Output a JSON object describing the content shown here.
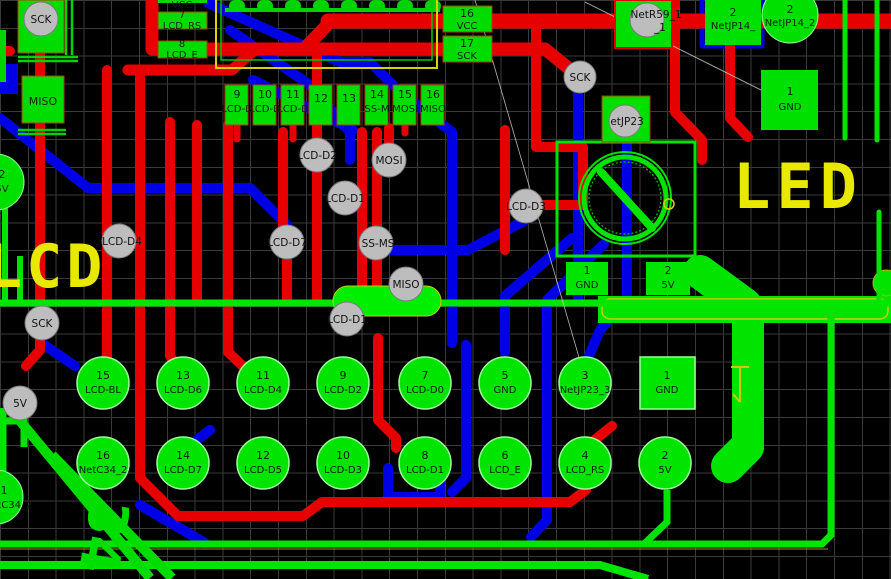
{
  "colors": {
    "copper_top": "#e60000",
    "copper_bottom": "#0000e6",
    "copper_green": "#00e400",
    "pad": "#00e400",
    "via": "#bdbdbd",
    "silk": "#e9e900",
    "grid": "#3a3a3a",
    "bg": "#000000"
  },
  "silkscreen": {
    "led_label": "LED",
    "lcd_label": "LCD",
    "label_34": "34"
  },
  "vias": {
    "sck_tl": "SCK",
    "sck_tr": "SCK",
    "sck_mid": "SCK",
    "v5": "5V",
    "d2": "LCD-D2",
    "mosi": "MOSI",
    "d1a": "LCD-D1",
    "d3": "LCD-D3",
    "d4": "LCD-D4",
    "d7": "LCD-D7",
    "ssms": "SS-MS",
    "miso": "MISO",
    "d1b": "LCD-D1",
    "netr59": "NetR59_1",
    "netr59b": "_1",
    "netjp23": "etJP23"
  },
  "top_header": {
    "pads": [
      {
        "num": "9",
        "net": "LCD-D"
      },
      {
        "num": "10",
        "net": "LCD-D"
      },
      {
        "num": "11",
        "net": "LCD-D"
      },
      {
        "num": "12",
        "net": ""
      },
      {
        "num": "13",
        "net": ""
      },
      {
        "num": "14",
        "net": "SS-M"
      },
      {
        "num": "15",
        "net": "MOSI"
      },
      {
        "num": "16",
        "net": "MISO"
      }
    ]
  },
  "left_header": {
    "l1": "VCC",
    "l2": "7",
    "l3": "LCD_RS",
    "l4": "8",
    "l5": "LCD_E"
  },
  "mid_pads": {
    "p16": {
      "num": "16",
      "net": "VCC"
    },
    "p17": {
      "num": "17",
      "net": "SCK"
    }
  },
  "tr": {
    "sq": {
      "num": "2",
      "net": "NetJP14_"
    },
    "circ": {
      "num": "2",
      "net": "NetJP14_2"
    },
    "gnd": {
      "num": "1",
      "net": "GND"
    }
  },
  "led": {
    "p1": {
      "num": "1",
      "net": "GND"
    },
    "p2": {
      "num": "2",
      "net": "5V"
    }
  },
  "bottom_header": {
    "row1": [
      {
        "num": "15",
        "net": "LCD-BL"
      },
      {
        "num": "13",
        "net": "LCD-D6"
      },
      {
        "num": "11",
        "net": "LCD-D4"
      },
      {
        "num": "9",
        "net": "LCD-D2"
      },
      {
        "num": "7",
        "net": "LCD-D0"
      },
      {
        "num": "5",
        "net": "GND"
      },
      {
        "num": "3",
        "net": "NetJP23_3"
      },
      {
        "num": "1",
        "net": "GND"
      }
    ],
    "row2": [
      {
        "num": "16",
        "net": "NetC34_2"
      },
      {
        "num": "14",
        "net": "LCD-D7"
      },
      {
        "num": "12",
        "net": "LCD-D5"
      },
      {
        "num": "10",
        "net": "LCD-D3"
      },
      {
        "num": "8",
        "net": "LCD-D1"
      },
      {
        "num": "6",
        "net": "LCD_E"
      },
      {
        "num": "4",
        "net": "LCD_RS"
      },
      {
        "num": "2",
        "net": "5V"
      }
    ]
  },
  "left_edge": {
    "miso_pad": "MISO",
    "cut_top": {
      "num": "2",
      "net": "5V"
    },
    "cut_bottom": {
      "num": "1",
      "net": "NetC34_2"
    }
  }
}
